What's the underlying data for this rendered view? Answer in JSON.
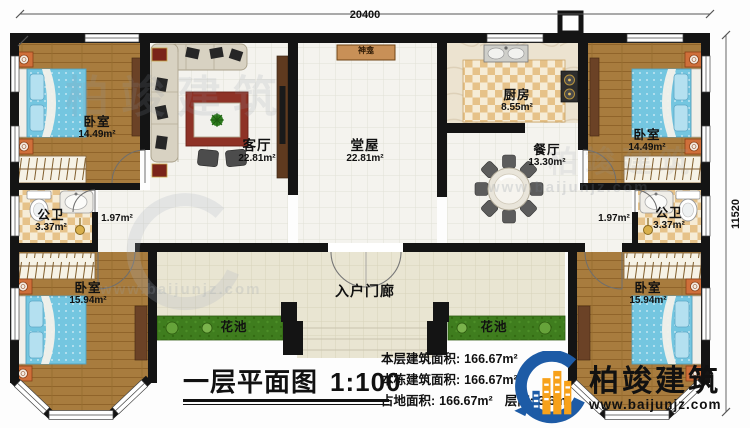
{
  "plan": {
    "title": "一层平面图",
    "scale": "1:100",
    "dim_top": "20400",
    "dim_right": "11520"
  },
  "rooms": {
    "bedroom_tl": {
      "label": "卧室",
      "area": "14.49m²"
    },
    "living": {
      "label": "客厅",
      "area": "22.81m²"
    },
    "hall": {
      "label": "堂屋",
      "area": "22.81m²"
    },
    "kitchen": {
      "label": "厨房",
      "area": "8.55m²"
    },
    "dining": {
      "label": "餐厅",
      "area": "13.30m²"
    },
    "bedroom_tr": {
      "label": "卧室",
      "area": "14.49m²"
    },
    "bath_left": {
      "label": "公卫",
      "area": "3.37m²"
    },
    "bath_right": {
      "label": "公卫",
      "area": "3.37m²"
    },
    "corridor_left": {
      "area": "1.97m²"
    },
    "corridor_right": {
      "area": "1.97m²"
    },
    "bedroom_bl": {
      "label": "卧室",
      "area": "15.94m²"
    },
    "bedroom_br": {
      "label": "卧室",
      "area": "15.94m²"
    },
    "porch": {
      "label": "入户门廊"
    },
    "shrine": {
      "label": "神龛"
    },
    "flower_left": {
      "label": "花池"
    },
    "flower_right": {
      "label": "花池"
    }
  },
  "stats": {
    "rows": [
      {
        "label": "本层建筑面积:",
        "value": "166.67m²"
      },
      {
        "label": "本栋建筑面积:",
        "value": "166.67m²"
      },
      {
        "label": "占地面积:",
        "value": "166.67m²",
        "label2": "层高:",
        "value2": "3.6m"
      }
    ]
  },
  "branding": {
    "company": "柏竣建筑",
    "website": "www.baijunjz.com",
    "brand_blue": "#1d5ba6",
    "brand_orange": "#f7a11a"
  },
  "colors": {
    "wall": "#141414",
    "wood_floor": "#a87c3e",
    "bed_blue": "#74c6e0",
    "checker_tan": "#e6c289",
    "flower_green": "#3f7d1e",
    "rug_red": "#8e3226"
  }
}
